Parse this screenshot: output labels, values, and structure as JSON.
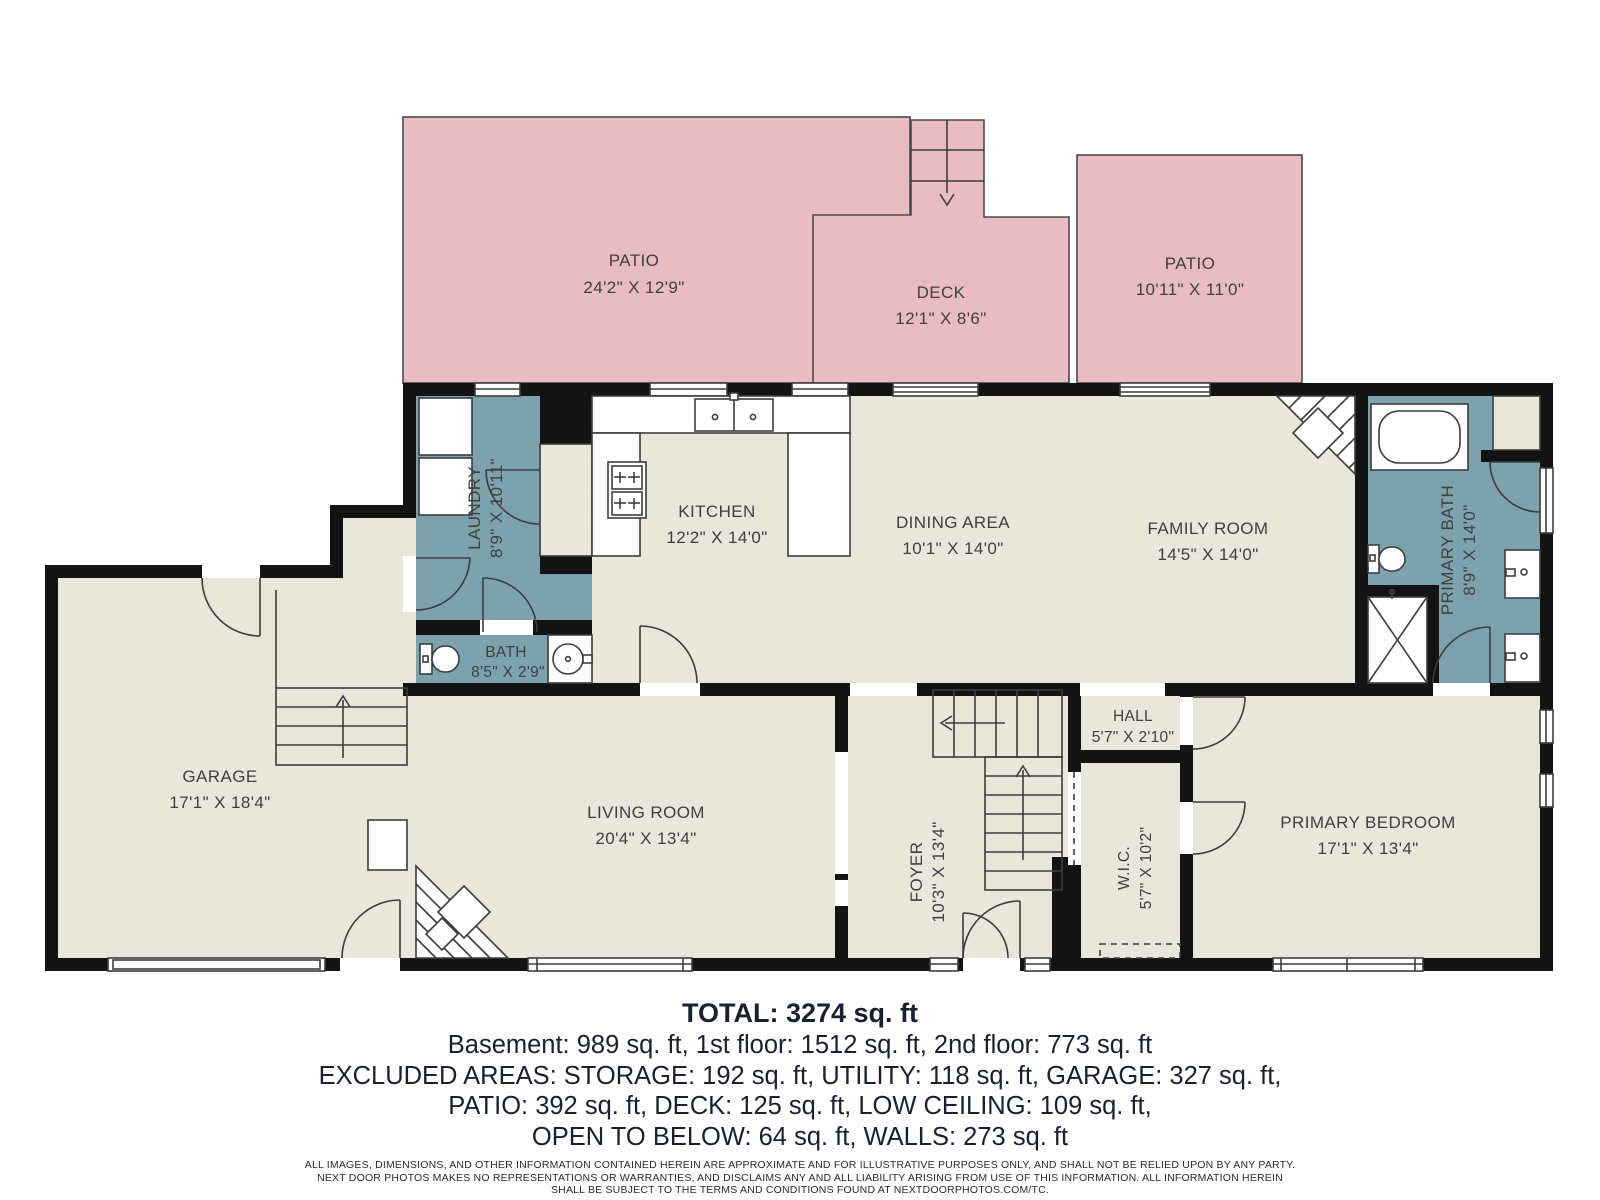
{
  "plan": {
    "outdoor": {
      "patio1": {
        "name": "PATIO",
        "dims": "24'2\" X 12'9\""
      },
      "deck": {
        "name": "DECK",
        "dims": "12'1\" X 8'6\""
      },
      "patio2": {
        "name": "PATIO",
        "dims": "10'11\" X 11'0\""
      }
    },
    "rooms": {
      "laundry": {
        "name": "LAUNDRY",
        "dims": "8'9\" X 10'11\""
      },
      "kitchen": {
        "name": "KITCHEN",
        "dims": "12'2\" X 14'0\""
      },
      "dining": {
        "name": "DINING AREA",
        "dims": "10'1\" X 14'0\""
      },
      "family": {
        "name": "FAMILY ROOM",
        "dims": "14'5\" X 14'0\""
      },
      "primary_bath": {
        "name": "PRIMARY BATH",
        "dims": "8'9\" X 14'0\""
      },
      "bath": {
        "name": "BATH",
        "dims": "8'5\" X 2'9\""
      },
      "garage": {
        "name": "GARAGE",
        "dims": "17'1\" X 18'4\""
      },
      "living": {
        "name": "LIVING ROOM",
        "dims": "20'4\" X 13'4\""
      },
      "foyer": {
        "name": "FOYER",
        "dims": "10'3\" X 13'4\""
      },
      "hall": {
        "name": "HALL",
        "dims": "5'7\" X 2'10\""
      },
      "wic": {
        "name": "W.I.C.",
        "dims": "5'7\" X 10'2\""
      },
      "primary_bedroom": {
        "name": "PRIMARY BEDROOM",
        "dims": "17'1\" X 13'4\""
      }
    }
  },
  "summary": {
    "total": "TOTAL: 3274 sq. ft",
    "line1": "Basement: 989 sq. ft, 1st floor: 1512 sq. ft, 2nd floor: 773 sq. ft",
    "line2": "EXCLUDED AREAS: STORAGE: 192 sq. ft, UTILITY: 118 sq. ft, GARAGE: 327 sq. ft,",
    "line3": "PATIO: 392 sq. ft, DECK: 125 sq. ft, LOW CEILING: 109 sq. ft,",
    "line4": "OPEN TO BELOW: 64 sq. ft, WALLS: 273 sq. ft"
  },
  "disclaimer": {
    "line1": "ALL IMAGES, DIMENSIONS, AND OTHER INFORMATION CONTAINED HEREIN ARE APPROXIMATE AND FOR ILLUSTRATIVE PURPOSES ONLY, AND SHALL NOT BE RELIED UPON BY ANY PARTY.",
    "line2": "NEXT DOOR PHOTOS MAKES NO REPRESENTATIONS OR WARRANTIES, AND DISCLAIMS ANY AND ALL LIABILITY ARISING FROM USE OF THIS INFORMATION. ALL INFORMATION HEREIN",
    "line3": "SHALL BE SUBJECT TO THE TERMS AND CONDITIONS FOUND AT NEXTDOORPHOTOS.COM/TC."
  },
  "colors": {
    "outdoor_pink": "#E9BCC1",
    "floor_beige": "#E9E6DA",
    "wet_teal": "#7CA3AD",
    "wall_black": "#131313",
    "line_gray": "#3d3d3d",
    "label_text": "#3f3f3f",
    "summary_text": "#1a2030"
  }
}
